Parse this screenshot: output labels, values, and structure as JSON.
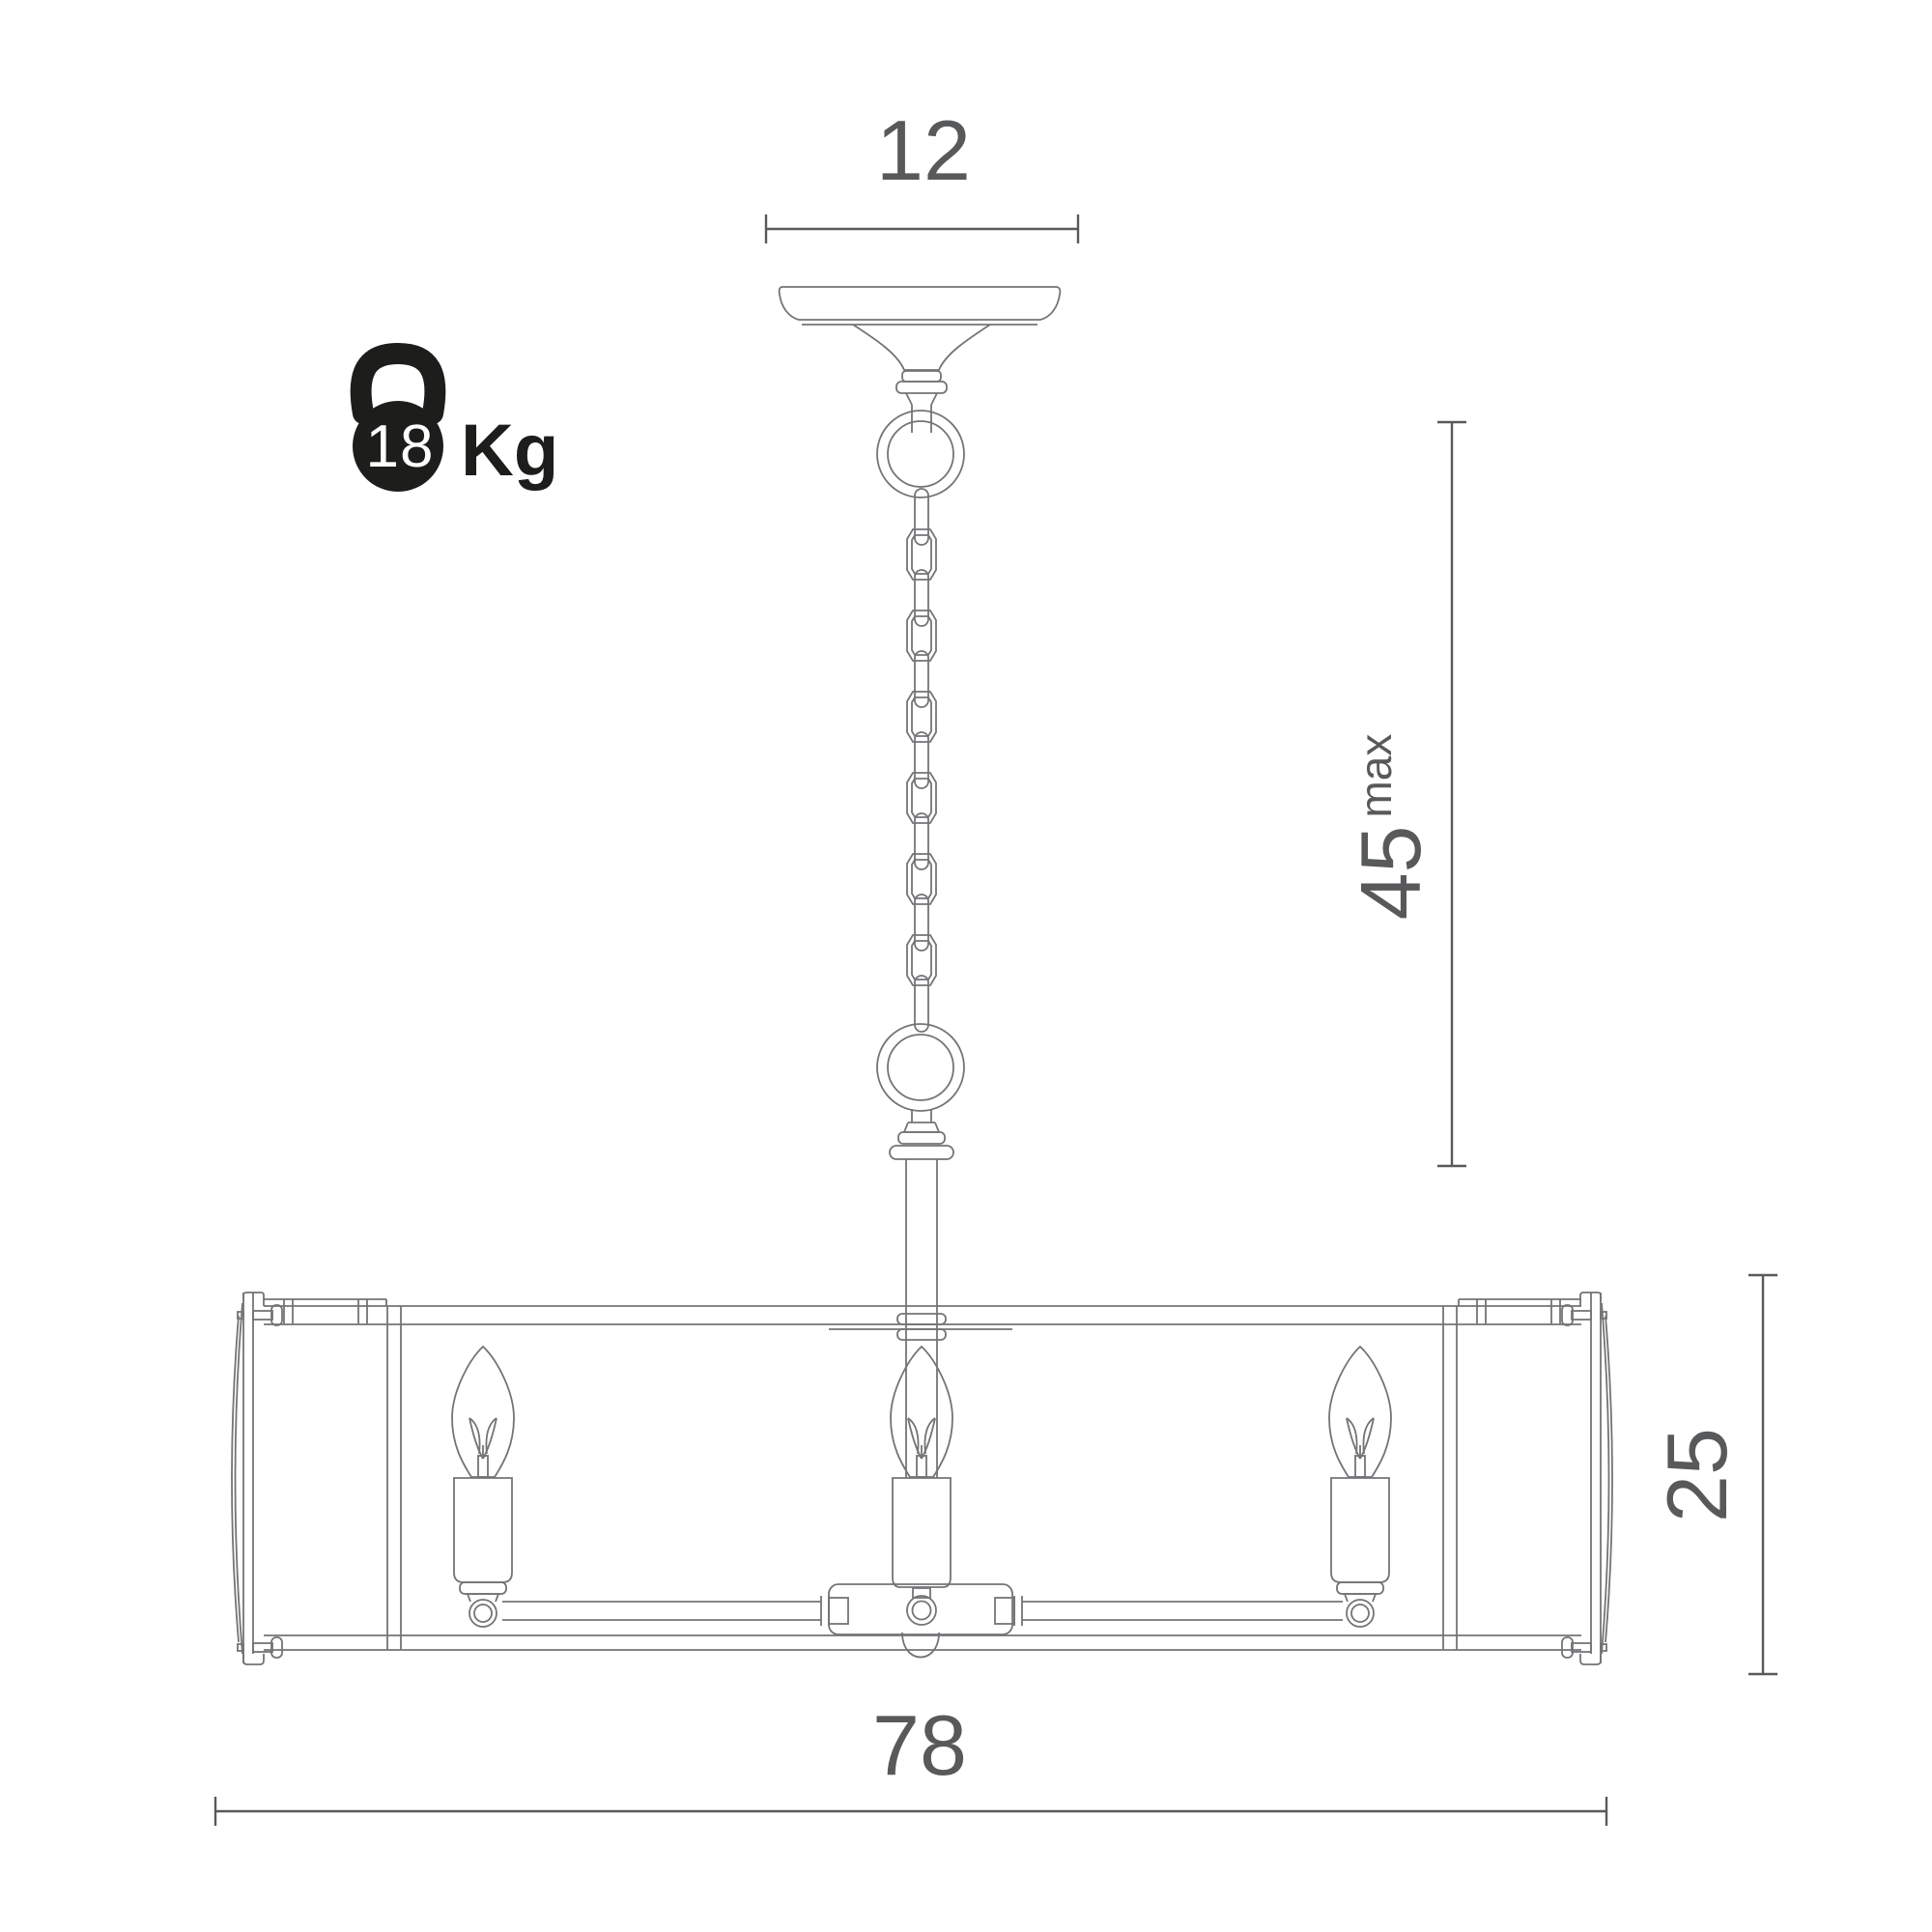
{
  "title": "chandelier-dimension-drawing",
  "dimensions": {
    "canopy_width": {
      "value": "12"
    },
    "hanging_height": {
      "value": "45",
      "suffix": "max"
    },
    "body_height": {
      "value": "25"
    },
    "body_width": {
      "value": "78"
    }
  },
  "weight": {
    "value": "18",
    "unit": "Kg"
  },
  "icon": "kettlebell-icon",
  "colors": {
    "background": "#ffffff",
    "line": "#737477",
    "dimension": "#58595b",
    "icon": "#1d1d1b",
    "weight_text": "#ffffff"
  }
}
